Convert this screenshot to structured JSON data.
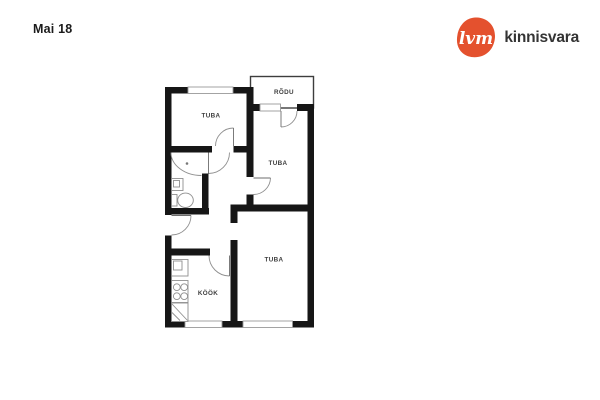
{
  "header": {
    "date_label": "Mai 18"
  },
  "logo": {
    "mark_text": "lvm",
    "brand_text": "kinnisvara",
    "brand_color": "#e4512e",
    "mark_text_color": "#ffffff",
    "brand_text_color": "#343434"
  },
  "floorplan": {
    "wall_color": "#161616",
    "line_color": "#8f8f8f",
    "rooms": [
      {
        "id": "tuba-1",
        "label": "TUBA"
      },
      {
        "id": "rodu",
        "label": "RÕDU"
      },
      {
        "id": "tuba-2",
        "label": "TUBA"
      },
      {
        "id": "tuba-3",
        "label": "TUBA"
      },
      {
        "id": "kook",
        "label": "KÖÖK"
      }
    ]
  }
}
